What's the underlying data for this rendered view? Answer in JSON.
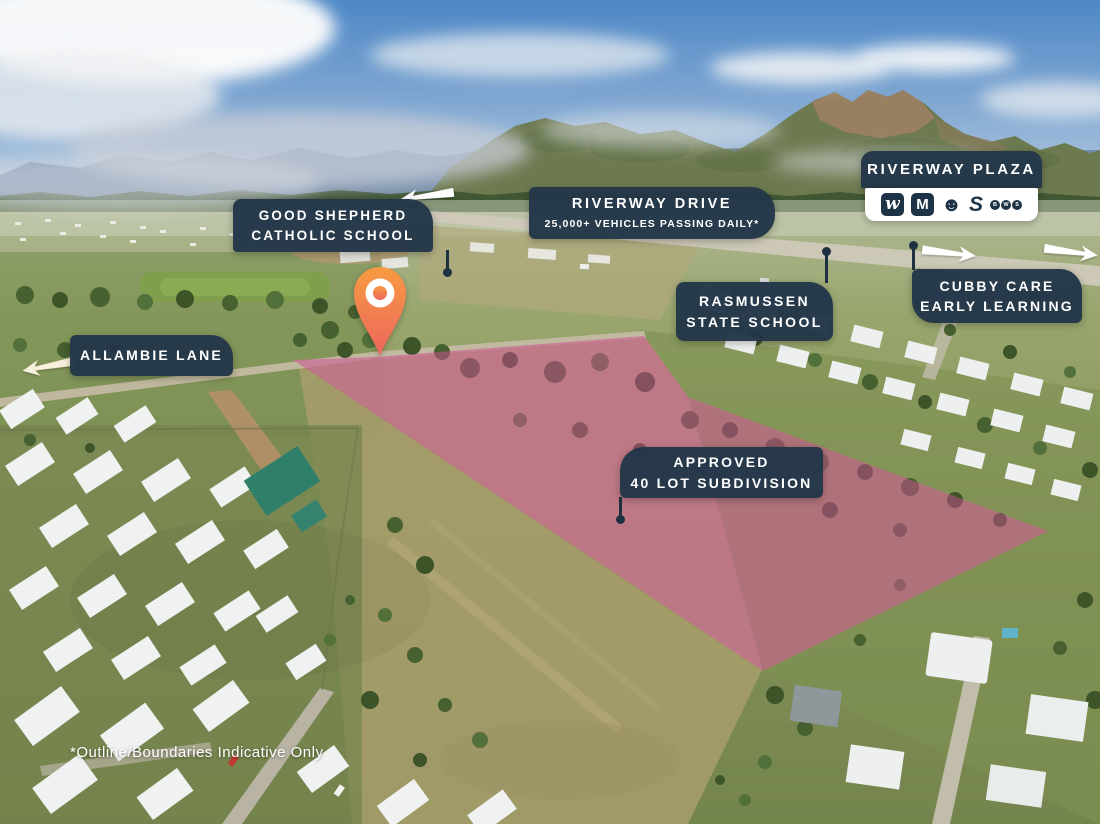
{
  "labels": {
    "good_shepherd": {
      "line1": "GOOD SHEPHERD",
      "line2": "CATHOLIC SCHOOL"
    },
    "riverway_drive": {
      "line1": "RIVERWAY DRIVE",
      "line2": "25,000+ VEHICLES PASSING DAILY*"
    },
    "rasmussen": {
      "line1": "RASMUSSEN",
      "line2": "STATE SCHOOL"
    },
    "cubby_care": {
      "line1": "CUBBY CARE",
      "line2": "EARLY LEARNING"
    },
    "allambie": {
      "line1": "ALLAMBIE LANE"
    },
    "approved": {
      "line1": "APPROVED",
      "line2": "40 LOT SUBDIVISION"
    }
  },
  "plaza": {
    "title": "RIVERWAY PLAZA",
    "tenants": [
      {
        "name": "Woolworths",
        "glyph": "w"
      },
      {
        "name": "McDonald's",
        "glyph": "M"
      },
      {
        "name": "KFC",
        "glyph": "☻"
      },
      {
        "name": "Subway",
        "glyph": "S"
      },
      {
        "name": "BWS",
        "letters": [
          "B",
          "W",
          "S"
        ]
      }
    ]
  },
  "disclaimer": "*Outline/Boundaries Indicative Only",
  "colors": {
    "label_bg": "#233749",
    "label_text": "#ffffff",
    "site_overlay": "#c94e92",
    "pin_top": "#f79b41",
    "pin_bottom": "#ec655e",
    "leader": "#1e3140",
    "arrow": "#ffffff"
  }
}
